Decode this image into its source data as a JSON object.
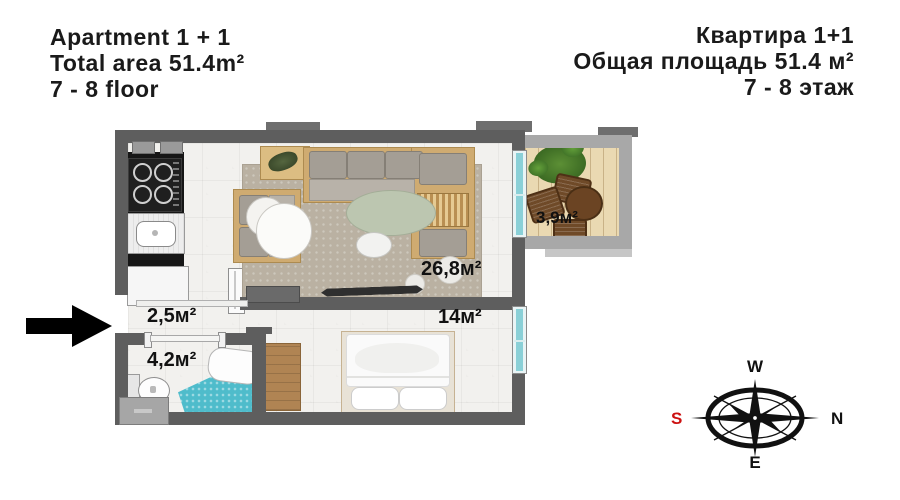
{
  "header": {
    "en": {
      "line1": "Apartment 1 + 1",
      "line2": "Total area 51.4m²",
      "line3": "7 - 8 floor"
    },
    "ru": {
      "line1": "Квартира 1+1",
      "line2": "Общая площадь 51.4 м²",
      "line3": "7 - 8 этаж"
    }
  },
  "plan": {
    "rooms": {
      "living": {
        "area_label": "26,8м²"
      },
      "balcony": {
        "area_label": "3,9м²"
      },
      "hallway": {
        "area_label": "2,5м²"
      },
      "bedroom": {
        "area_label": "14м²"
      },
      "bathroom": {
        "area_label": "4,2м²"
      }
    }
  },
  "compass": {
    "west": "W",
    "north": "N",
    "east": "E",
    "south": "S"
  },
  "colors": {
    "wall_dark": "#5e5e5e",
    "wall_light": "#a8a8a8",
    "glass_teal": "#8ad0d7",
    "mosaic_teal": "#4fbccb",
    "wood": "#cfab71",
    "south_red": "#cc1111",
    "text": "#1a1a1a"
  }
}
